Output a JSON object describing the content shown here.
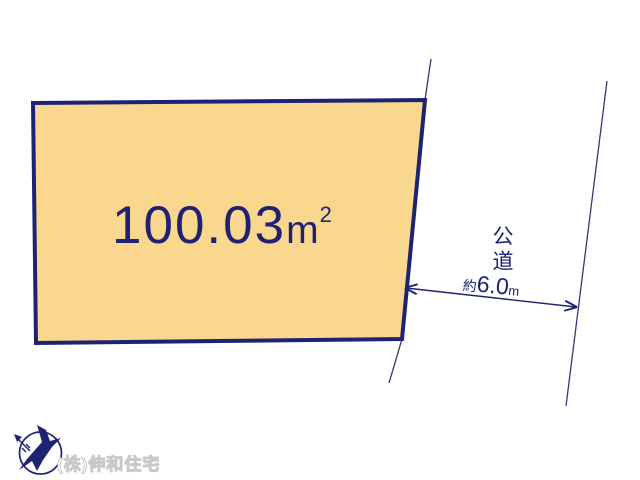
{
  "diagram": {
    "type": "land-plot-site-plan",
    "parcel": {
      "area_value": "100.03",
      "area_unit": "m",
      "area_superscript": "2"
    },
    "road": {
      "label": "公道",
      "width_prefix": "約",
      "width_value": "6.0",
      "width_unit": "m"
    },
    "footer": {
      "company_name": "(株)伸和住宅",
      "logo_icon": "north-arrow-bird-compass"
    },
    "colors": {
      "line_navy": "#1e2272",
      "road_edge_navy": "#343879",
      "parcel_fill": "#f9d78e",
      "watermark_gray": "#c9c9c9",
      "background": "#ffffff"
    }
  }
}
